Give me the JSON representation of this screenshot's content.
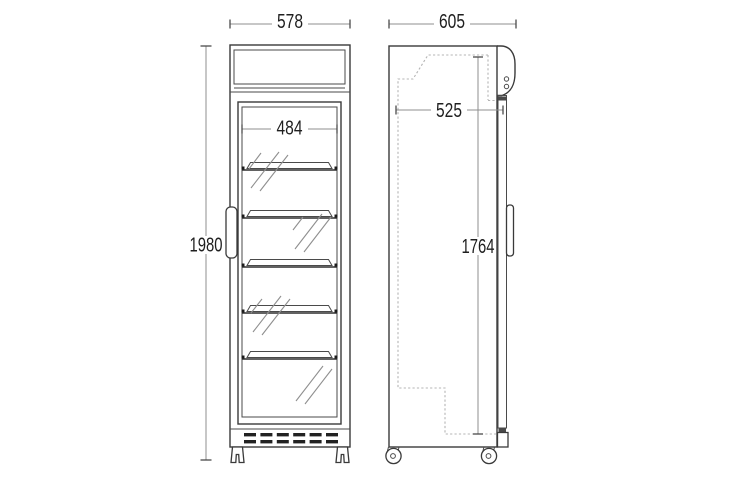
{
  "title": "Glass door display cooler - dimensional drawing",
  "dimensions": {
    "front_width": "578",
    "front_inner_width": "484",
    "front_height": "1980",
    "side_depth": "605",
    "side_inner_depth": "525",
    "side_inner_height": "1764"
  },
  "structure": {
    "front_shelf_count": 5,
    "grille_dash_rows": 2,
    "grille_dashes_per_row": 6
  },
  "colors": {
    "background": "#ffffff",
    "outline": "#3a3a3a",
    "dimension_line": "#8f8f8f",
    "dimension_text": "#1f1f1f",
    "dashed_liner": "#b4b4b4",
    "grille_fill": "#222222"
  }
}
